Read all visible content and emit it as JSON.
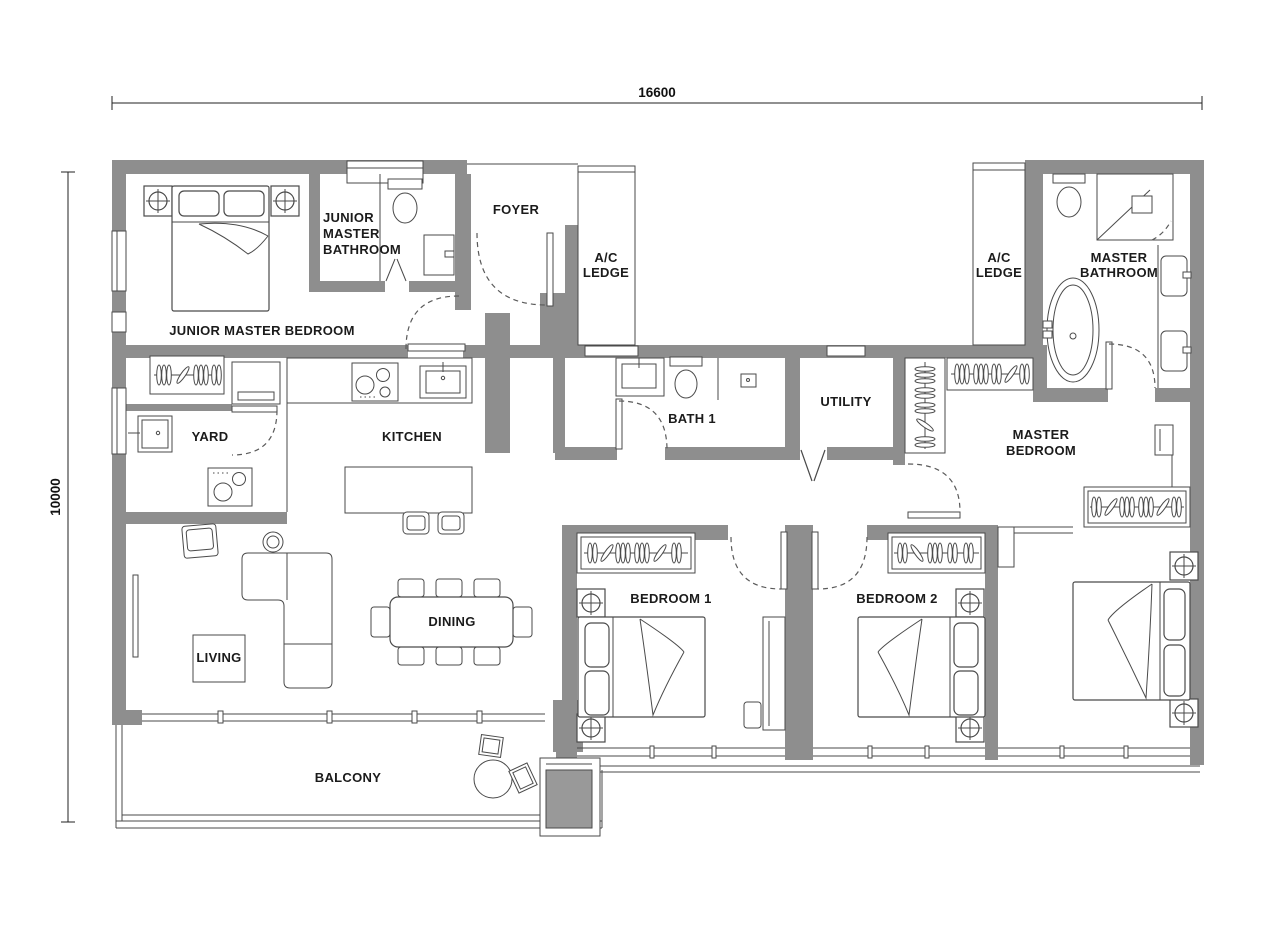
{
  "plan": {
    "type": "residential floor plan",
    "dimensions": {
      "top_width": "16600",
      "left_height": "10000"
    },
    "rooms": {
      "junior_master_bedroom": {
        "label": "JUNIOR MASTER BEDROOM"
      },
      "junior_master_bathroom": {
        "line1": "JUNIOR",
        "line2": "MASTER",
        "line3": "BATHROOM"
      },
      "foyer": {
        "label": "FOYER"
      },
      "ac_ledge_left": {
        "line1": "A/C",
        "line2": "LEDGE"
      },
      "ac_ledge_right": {
        "line1": "A/C",
        "line2": "LEDGE"
      },
      "master_bathroom": {
        "line1": "MASTER",
        "line2": "BATHROOM"
      },
      "yard": {
        "label": "YARD"
      },
      "kitchen": {
        "label": "KITCHEN"
      },
      "bath_1": {
        "label": "BATH 1"
      },
      "utility": {
        "label": "UTILITY"
      },
      "master_bedroom": {
        "line1": "MASTER",
        "line2": "BEDROOM"
      },
      "living": {
        "label": "LIVING"
      },
      "dining": {
        "label": "DINING"
      },
      "bedroom_1": {
        "label": "BEDROOM 1"
      },
      "bedroom_2": {
        "label": "BEDROOM 2"
      },
      "balcony": {
        "label": "BALCONY"
      }
    },
    "colors": {
      "wall": "#8e8e8e",
      "line": "#4a4a4a",
      "text": "#1b1b1b",
      "background": "#ffffff"
    },
    "furniture_inventory": [
      "double-bed",
      "pillow",
      "nightstand-lamp",
      "sliding-wardrobe",
      "walk-in-wardrobe",
      "toilet",
      "vanity-sink",
      "shower",
      "bathtub",
      "basin",
      "kitchen-counter",
      "cooktop-4-burner",
      "cooktop-2-burner",
      "kitchen-sink",
      "kitchen-island",
      "bar-stool",
      "washer",
      "yard-sink",
      "dining-table",
      "dining-chair",
      "l-shaped-sofa",
      "armchair",
      "side-table",
      "coffee-table",
      "desk",
      "desk-chair",
      "balcony-round-table",
      "balcony-chair",
      "planter",
      "swing-door",
      "bifold-door",
      "sliding-glass-door",
      "window"
    ]
  }
}
